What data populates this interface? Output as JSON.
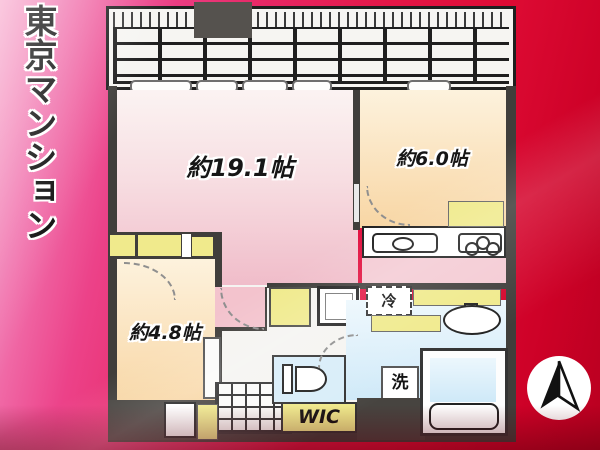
{
  "banner": {
    "title": "東京マンション"
  },
  "floorplan": {
    "labels": {
      "living": "約19.1帖",
      "service_room": "約6.0帖",
      "bedroom": "約4.8帖",
      "refrigerator": "冷",
      "laundry": "洗",
      "wic": "WIC"
    },
    "colors": {
      "wall": "#403e3b",
      "room_pink": "#f0bcc9",
      "room_orange": "#f8d6a4",
      "closet_yellow": "#f0ea8c",
      "wet_area_blue": "#cfe9f8",
      "background_pink": "#ec4289",
      "background_red": "#d40129"
    },
    "compass": {
      "direction": "north"
    }
  }
}
